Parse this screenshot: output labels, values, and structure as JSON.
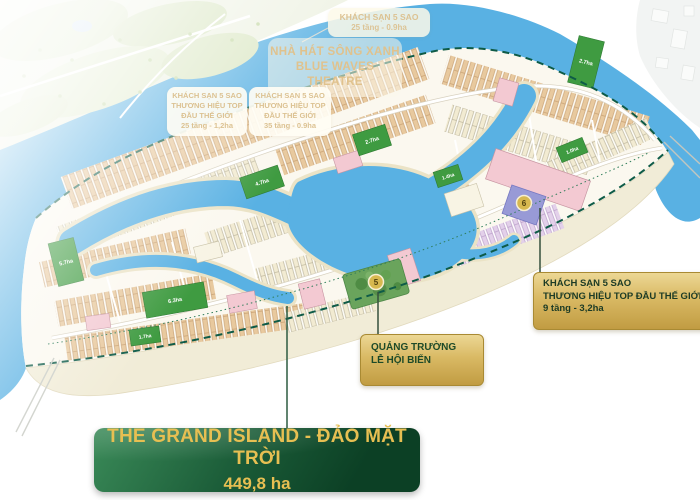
{
  "map": {
    "region_labels": {
      "hotel_top": {
        "line1": "KHÁCH SẠN 5 SAO",
        "line2": "25 tầng - 0.9ha"
      },
      "theatre": {
        "line1": "NHÀ HÁT SÔNG XANH",
        "line2": "BLUE WAVES THEATRE"
      },
      "hotel_left": {
        "line1": "KHÁCH SẠN 5 SAO",
        "line2": "THƯƠNG HIỆU TOP",
        "line3": "ĐẦU THẾ GIỚI",
        "line4": "25 tầng - 1,2ha"
      },
      "hotel_mid": {
        "line1": "KHÁCH SẠN 5 SAO",
        "line2": "THƯƠNG HIỆU TOP",
        "line3": "ĐẦU THẾ GIỚI",
        "line4": "35 tầng - 0.9ha"
      }
    },
    "callouts": {
      "hotel5star": {
        "line1": "KHÁCH SẠN 5 SAO",
        "line2": "THƯƠNG HIỆU TOP ĐẦU THẾ GIỚI",
        "line3": "9 tầng - 3,2ha",
        "marker": "6"
      },
      "plaza": {
        "line1": "QUẢNG TRƯỜNG",
        "line2": "LỄ HỘI BIỂN",
        "marker": "5"
      }
    },
    "park_labels": [
      "5.7ha",
      "4.7ha",
      "2.7ha",
      "2.7ha",
      "6.3ha",
      "1.4ha",
      "1.0ha",
      "1.7ha"
    ],
    "banner": {
      "title": "THE GRAND ISLAND - ĐẢO MẶT TRỜI",
      "area": "449,8 ha"
    },
    "colors": {
      "water": "#59b1e3",
      "sand": "#f1ecd7",
      "park_green": "#3f9b41",
      "gold": "#d7b84f",
      "banner_green": "#11502f",
      "boundary_dash": "#0e5b47",
      "hotel_block_purple": "#989ad6"
    }
  }
}
